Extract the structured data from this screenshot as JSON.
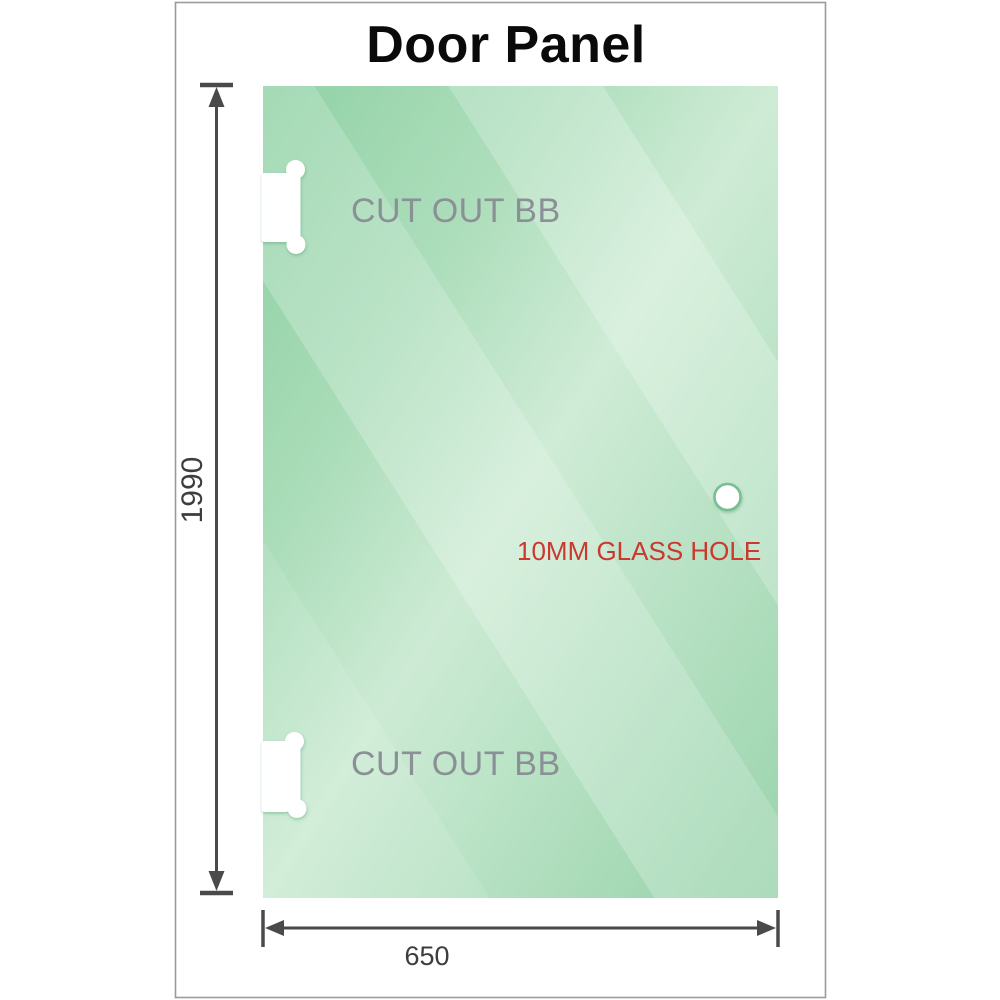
{
  "title": "Door Panel",
  "panel": {
    "cutout_top_label": "CUT OUT BB",
    "cutout_bottom_label": "CUT OUT BB",
    "hole_label": "10MM GLASS HOLE"
  },
  "dimensions": {
    "height_label": "1990",
    "width_label": "650"
  },
  "colors": {
    "glass_green": "#8bcfa1",
    "glass_highlight": "#cdebd4",
    "cutout_label_gray": "#8a9095",
    "hole_label_red": "#cb382e",
    "dimension_dark": "#3d3d3d",
    "dimension_line": "#4a4a4a",
    "frame_border": "#9b9b9b",
    "title_black": "#0a0a0a"
  }
}
